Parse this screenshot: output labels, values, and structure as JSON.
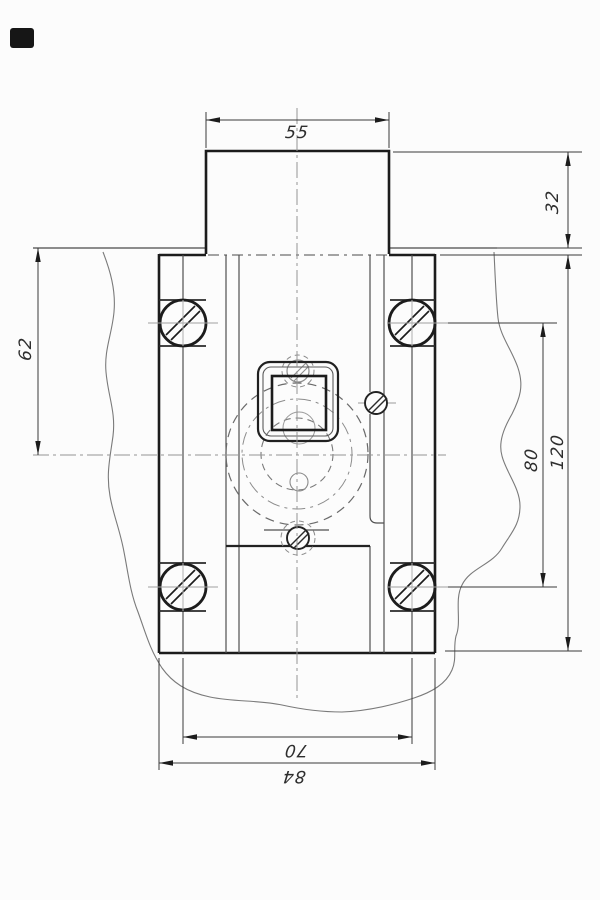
{
  "drawing": {
    "type": "mechanical engineering drawing",
    "description": "front view of a housing with square opening, four slotted screws, mounted through a broken-out plate",
    "colors": {
      "background": "#fcfcfc",
      "outline": "#1c1c1c",
      "thin_line": "#555555",
      "centerline": "#959595",
      "hidden_line": "#6e6e6e",
      "label": "#2e2e2e"
    },
    "dimension_labels": {
      "d55": "55",
      "d32": "32",
      "d62": "62",
      "d80": "80",
      "d120": "120",
      "d70": "70",
      "d84": "84"
    },
    "dimensions": [
      {
        "value": "55",
        "measures": "width of top block",
        "orientation": "horizontal",
        "position": "top"
      },
      {
        "value": "32",
        "measures": "height of top block above plate",
        "orientation": "vertical",
        "position": "upper-right"
      },
      {
        "value": "62",
        "measures": "plate surface to horizontal centerline",
        "orientation": "vertical",
        "position": "left"
      },
      {
        "value": "80",
        "measures": "spacing between screw rows",
        "orientation": "vertical",
        "position": "right"
      },
      {
        "value": "120",
        "measures": "overall body height",
        "orientation": "vertical",
        "position": "right-outer"
      },
      {
        "value": "70",
        "measures": "spacing between screw columns",
        "orientation": "horizontal",
        "position": "bottom"
      },
      {
        "value": "84",
        "measures": "overall body width",
        "orientation": "horizontal",
        "position": "bottom-outer"
      }
    ],
    "features": {
      "big_screws": 4,
      "small_screws": 3,
      "square_opening": true,
      "hidden_circles": 3,
      "break_lines": true
    }
  }
}
